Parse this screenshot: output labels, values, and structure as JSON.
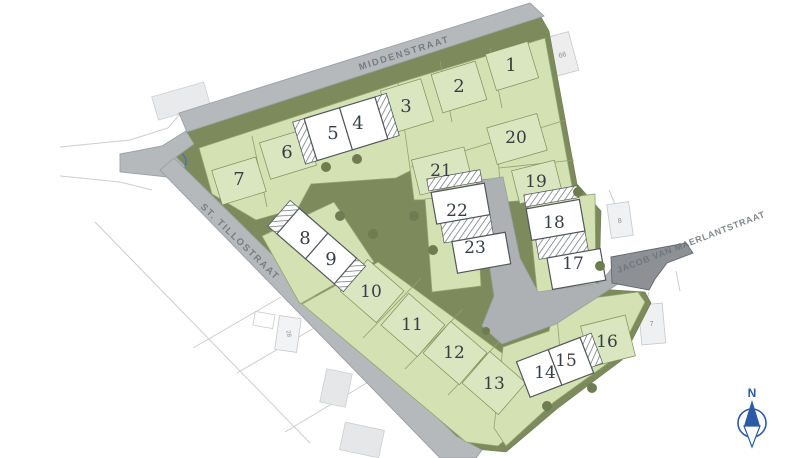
{
  "map": {
    "title": "verkavelingsplan",
    "streets": {
      "middenstraat": "MIDDENSTRAAT",
      "st_tillostraat": "ST. TILLOSTRAAT",
      "jacob_van_maerlantstraat": "JACOB VAN MAERLANTSTRAAT"
    },
    "lots": [
      {
        "number": "1",
        "status": "available"
      },
      {
        "number": "2",
        "status": "available"
      },
      {
        "number": "3",
        "status": "available"
      },
      {
        "number": "4",
        "status": "sold"
      },
      {
        "number": "5",
        "status": "sold"
      },
      {
        "number": "6",
        "status": "available"
      },
      {
        "number": "7",
        "status": "available"
      },
      {
        "number": "8",
        "status": "sold"
      },
      {
        "number": "9",
        "status": "sold"
      },
      {
        "number": "10",
        "status": "available"
      },
      {
        "number": "11",
        "status": "available"
      },
      {
        "number": "12",
        "status": "available"
      },
      {
        "number": "13",
        "status": "available"
      },
      {
        "number": "14",
        "status": "sold"
      },
      {
        "number": "15",
        "status": "sold"
      },
      {
        "number": "16",
        "status": "available"
      },
      {
        "number": "17",
        "status": "sold"
      },
      {
        "number": "18",
        "status": "sold"
      },
      {
        "number": "19",
        "status": "available"
      },
      {
        "number": "20",
        "status": "available"
      },
      {
        "number": "21",
        "status": "available"
      },
      {
        "number": "22",
        "status": "sold"
      },
      {
        "number": "23",
        "status": "sold"
      }
    ],
    "context_buildings": [
      {
        "label": "66"
      },
      {
        "label": "8"
      },
      {
        "label": "7"
      },
      {
        "label": "28"
      }
    ],
    "compass": {
      "north_label": "N"
    },
    "colors": {
      "parcel_green": "#d3e1b3",
      "envelope_green": "#dae6bf",
      "reserve_olive": "#7c8a5c",
      "road_gray": "#b6b9bc",
      "street_stub_gray": "#8d9196",
      "sold_white": "#ffffff",
      "compass_blue": "#2a5aa5"
    }
  }
}
